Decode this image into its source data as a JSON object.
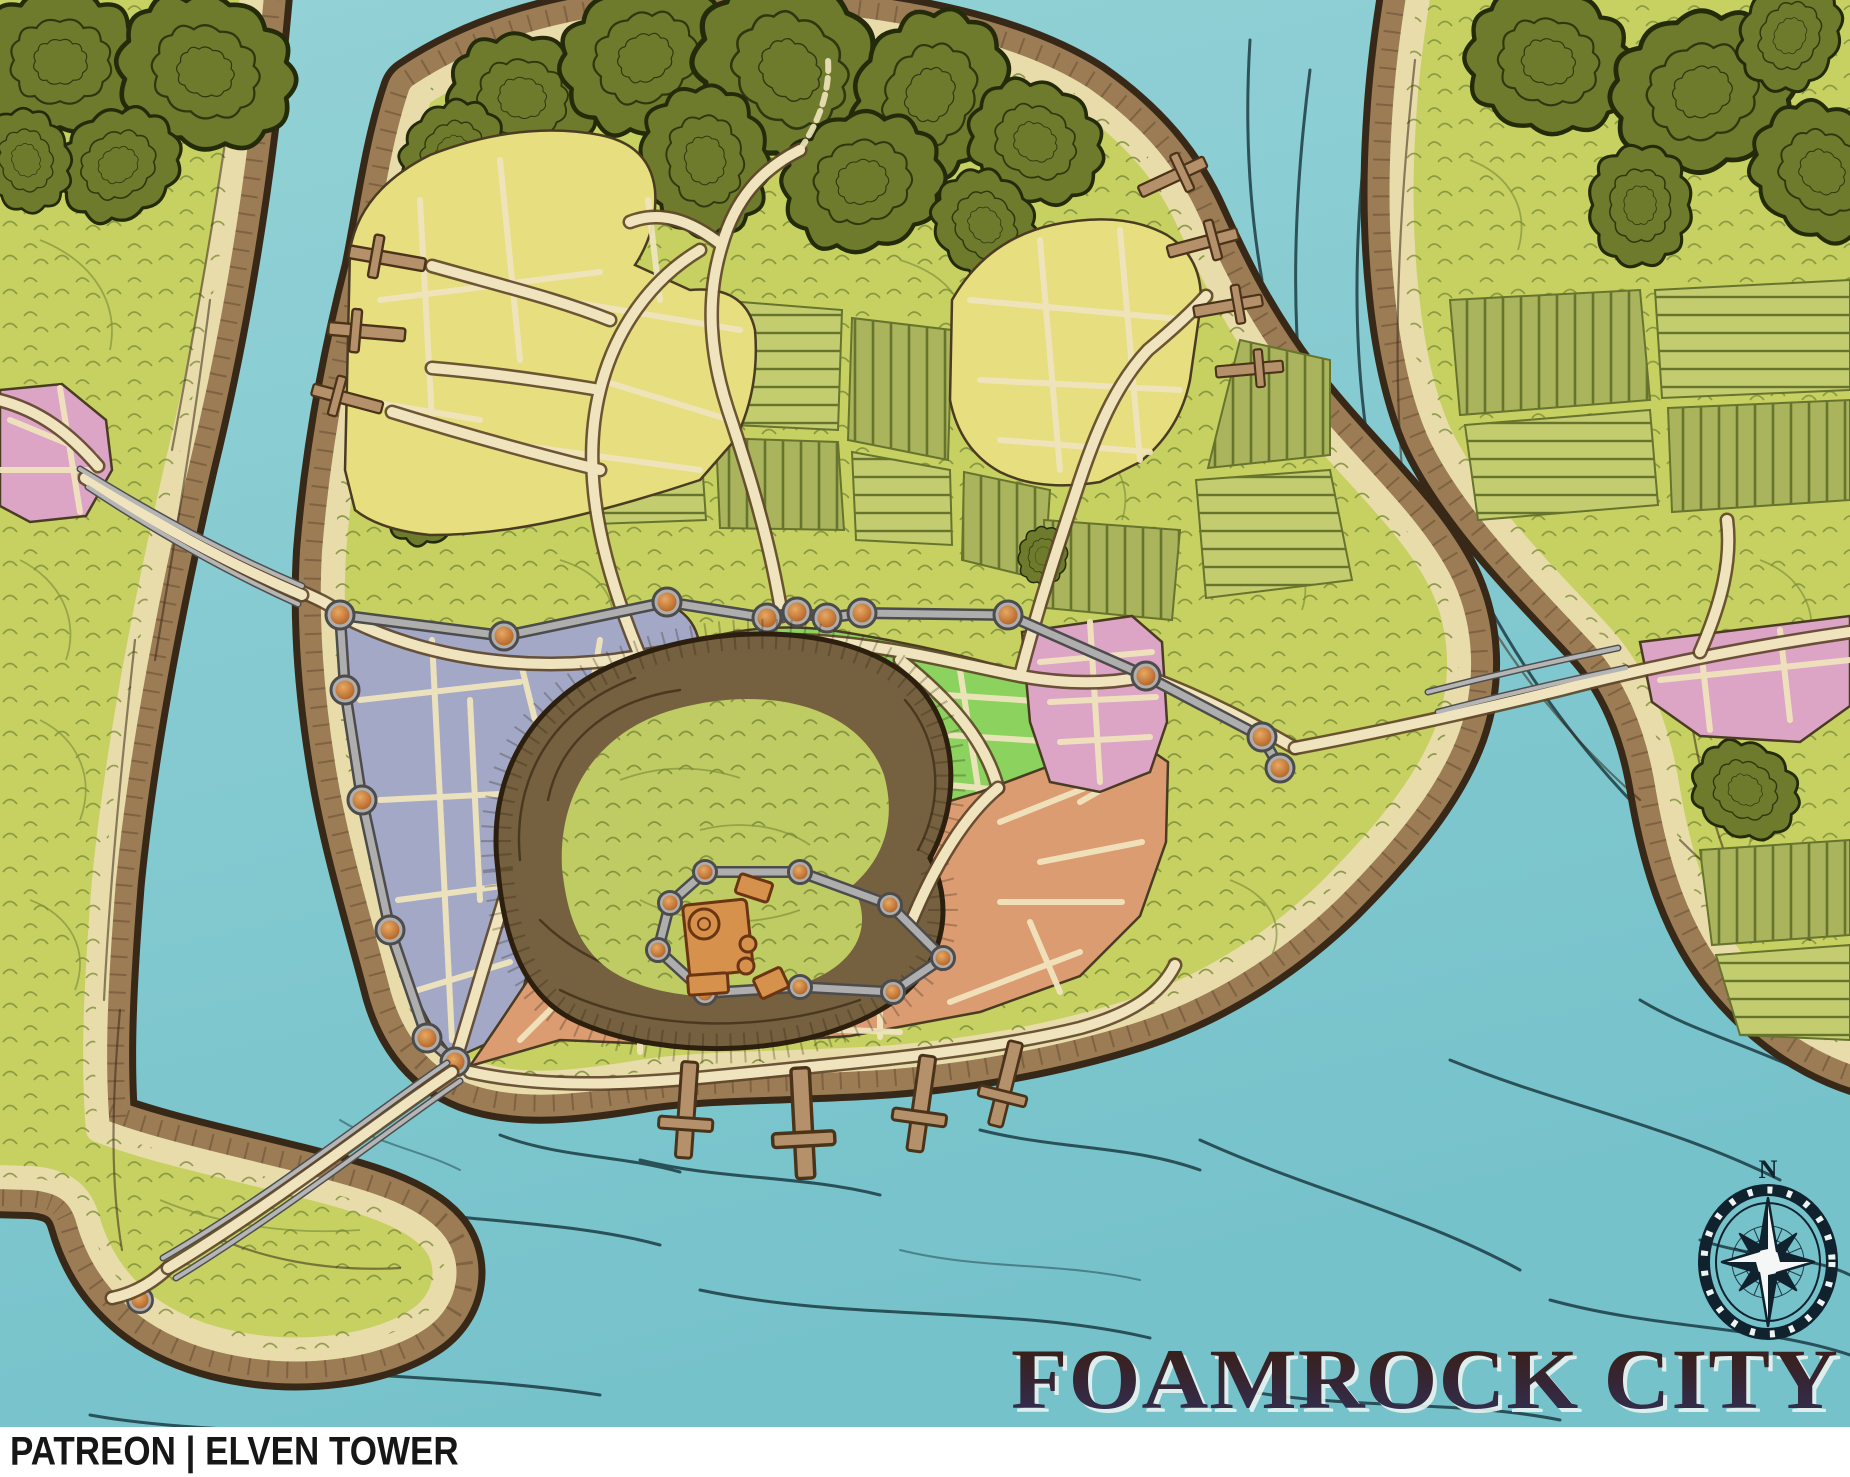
{
  "map": {
    "title": "FOAMROCK CITY"
  },
  "footer": {
    "credit": "PATREON | ELVEN TOWER"
  },
  "compass": {
    "north_label": "N"
  },
  "palette": {
    "water": "#93d2d6",
    "waterDeep": "#76c2cb",
    "waterLine": "#17333b",
    "bank": "#9c7c55",
    "bankDark": "#382817",
    "sand": "#e9dcab",
    "grass": "#c7d162",
    "scrib": "#7d8e3b",
    "forest": "#6e7a2c",
    "forestDark": "#242b0a",
    "field": "#aab45c",
    "fieldLight": "#c3cc6e",
    "fieldLine": "#67742e",
    "road": "#efe4bd",
    "roadEdge": "#5e462a",
    "wall": "#aeaeae",
    "wallEdge": "#4c4c4c",
    "tower": "#c9772f",
    "towerEdge": "#6e3c14",
    "cliff": "#75603f",
    "cliffLine": "#2c1f0e",
    "hillGrass": "#bfcb63",
    "keep": "#d6924c",
    "keepEdge": "#6b3513",
    "pier": "#b4916a",
    "pierEdge": "#4b3319",
    "districtYellow": "#e7de7f",
    "districtBlue": "#a2a8c6",
    "districtGreen": "#8bd25e",
    "districtOrange": "#dc9c72",
    "districtPink": "#dca4c5",
    "blockEdge": "#4a3c22",
    "titleTop": "#3a1d12",
    "titleBottom": "#31305a",
    "titleGlow": "#e9f3f1",
    "compassDark": "#10222e",
    "footerBg": "#ffffff",
    "footerText": "#161616"
  }
}
